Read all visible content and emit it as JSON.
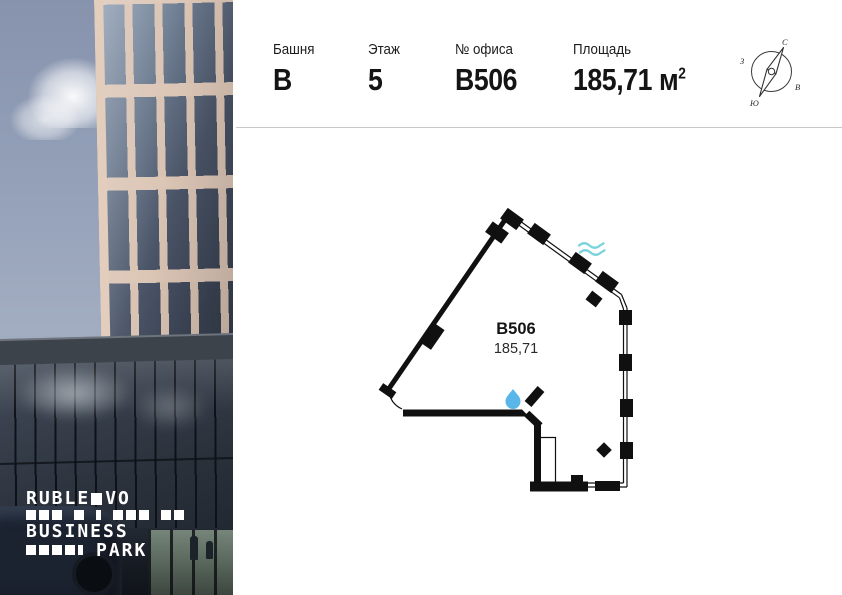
{
  "header": {
    "fields": [
      {
        "label": "Башня",
        "value": "В"
      },
      {
        "label": "Этаж",
        "value": "5"
      },
      {
        "label": "№ офиса",
        "value": "В506"
      },
      {
        "label": "Площадь",
        "value": "185,71 м",
        "sup": "2"
      }
    ]
  },
  "compass": {
    "north_label": "С",
    "south_label": "Ю",
    "west_label": "З",
    "east_label": "В"
  },
  "floor_plan": {
    "unit_label": "В506",
    "area_label": "185,71",
    "wall_color": "#101010",
    "water_drop_color": "#58b7e8",
    "waves_color": "#7cd3dc"
  },
  "logo": {
    "word1_left": "RUBLE",
    "word1_right": "VO",
    "word2": "BUSINESS",
    "word3": "PARK"
  }
}
